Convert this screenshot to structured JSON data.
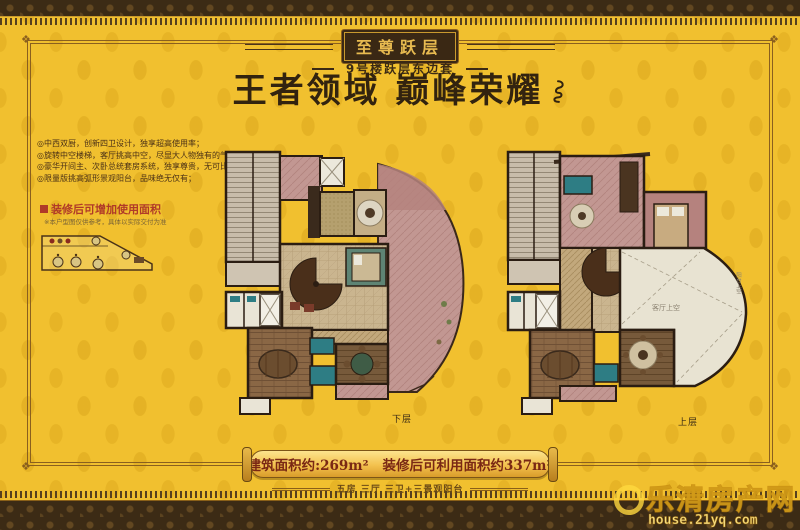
{
  "colors": {
    "background_gold": "#f1c02f",
    "border_brown": "#3c2b15",
    "title_brown": "#32230f",
    "banner_text_red": "#7a2814",
    "inset_title_red": "#b03a28",
    "terrace_pink": "#c29792",
    "wall_dark": "#2b1d12",
    "bath_teal": "#2e7d84",
    "watermark_yellow": "#ffd83e"
  },
  "header": {
    "badge": "至尊跃层",
    "subtitle": "9号楼跃层东边套",
    "title": "王者领域 巅峰荣耀"
  },
  "features": {
    "items": [
      "◎中西双厨，创新四卫设计，独享超高使用率；",
      "◎旋转中空楼梯，客厅挑高中空，尽显大人物独有的气度；",
      "◎豪华开间主、次卧总统套房系统，独享尊贵，无可比拟；",
      "◎限量版挑高弧形景观阳台，品味绝无仅有；"
    ]
  },
  "inset": {
    "title": "装修后可增加使用面积",
    "note": "※本户型图仅供参考，具体以实际交付为准"
  },
  "plans": {
    "lower_label": "下层",
    "upper_label": "上层",
    "void_label": "客厅上空",
    "balcony_label": "阳台上空"
  },
  "banner": {
    "area1_label": "建筑面积约:",
    "area1_value": "269m²",
    "area2_label": "装修后可利用面积约",
    "area2_value": "337m²",
    "subline": "五房 三厅 三卫+三景观阳台"
  },
  "watermark": {
    "site_name": "乐清房产网",
    "site_url": "house.21yq.com"
  }
}
